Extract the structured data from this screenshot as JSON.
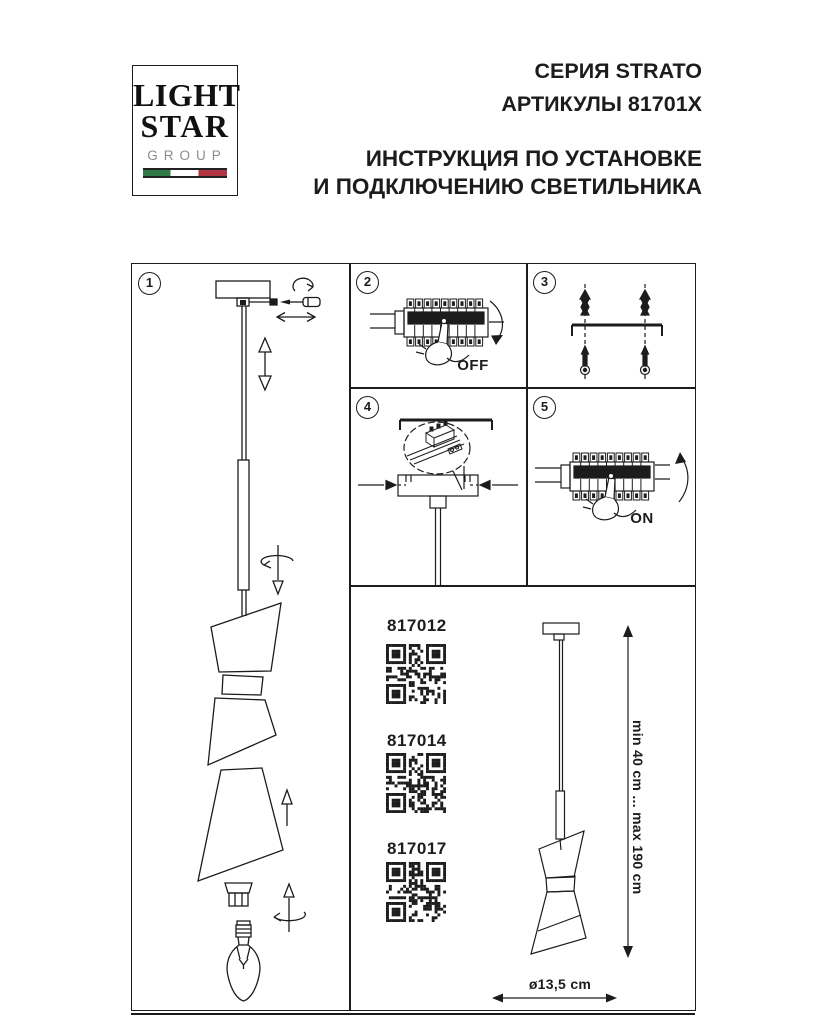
{
  "page": {
    "paper": "#ffffff",
    "ink": "#1c1c1c"
  },
  "header": {
    "logo": {
      "line1": "LIGHT",
      "line2": "STAR",
      "line3": "GROUP",
      "flag_green": "#2f7a47",
      "flag_white": "#ffffff",
      "flag_red": "#b03442"
    },
    "series": "СЕРИЯ STRATO",
    "articles": "АРТИКУЛЫ 81701X",
    "title_line1": "ИНСТРУКЦИЯ ПО УСТАНОВКЕ",
    "title_line2": "И ПОДКЛЮЧЕНИЮ СВЕТИЛЬНИКА"
  },
  "steps": {
    "step1": {
      "number": "1"
    },
    "step2": {
      "number": "2",
      "switch_label": "OFF"
    },
    "step3": {
      "number": "3"
    },
    "step4": {
      "number": "4"
    },
    "step5": {
      "number": "5",
      "switch_label": "ON"
    }
  },
  "articles_panel": {
    "items": [
      {
        "code": "817012"
      },
      {
        "code": "817014"
      },
      {
        "code": "817017"
      }
    ],
    "suspension_range": "min 40 cm ... max 190 cm",
    "diameter": "ø13,5 cm"
  }
}
